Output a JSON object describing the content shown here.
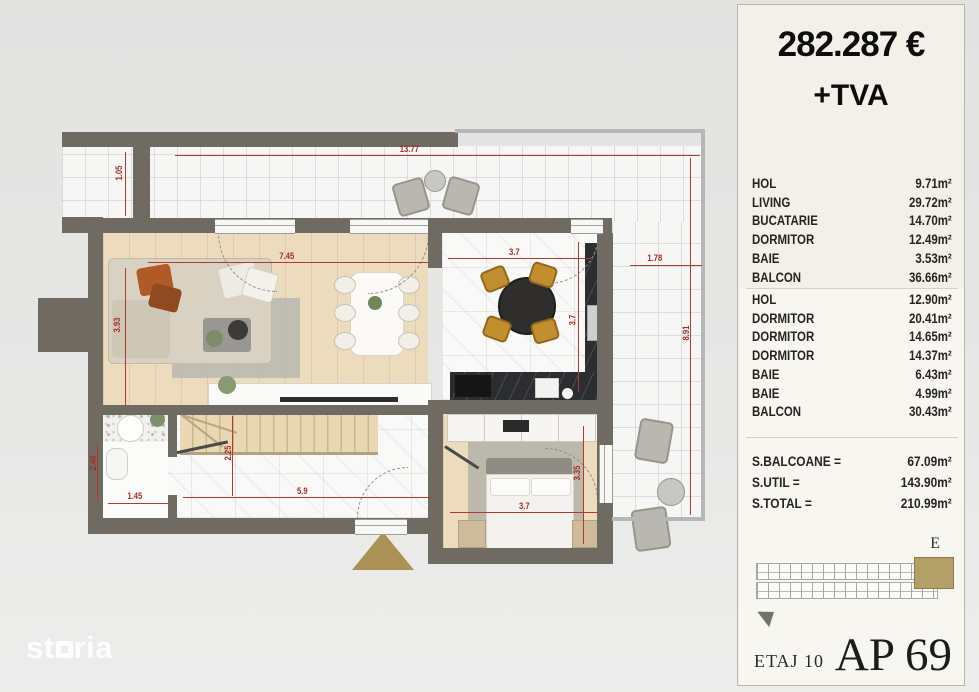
{
  "panel": {
    "price": "282.287 €",
    "vat": "+TVA",
    "rooms1": [
      {
        "label": "HOL",
        "area": "9.71m²"
      },
      {
        "label": "LIVING",
        "area": "29.72m²"
      },
      {
        "label": "BUCATARIE",
        "area": "14.70m²"
      },
      {
        "label": "DORMITOR",
        "area": "12.49m²"
      },
      {
        "label": "BAIE",
        "area": "3.53m²"
      },
      {
        "label": "BALCON",
        "area": "36.66m²"
      }
    ],
    "rooms2": [
      {
        "label": "HOL",
        "area": "12.90m²"
      },
      {
        "label": "DORMITOR",
        "area": "20.41m²"
      },
      {
        "label": "DORMITOR",
        "area": "14.65m²"
      },
      {
        "label": "DORMITOR",
        "area": "14.37m²"
      },
      {
        "label": "BAIE",
        "area": "6.43m²"
      },
      {
        "label": "BAIE",
        "area": "4.99m²"
      },
      {
        "label": "BALCON",
        "area": "30.43m²"
      }
    ],
    "totals": [
      {
        "label": "S.BALCOANE =",
        "value": "67.09m²"
      },
      {
        "label": "S.UTIL =",
        "value": "143.90m²"
      },
      {
        "label": "S.TOTAL =",
        "value": "210.99m²"
      }
    ],
    "section_label": "E",
    "floor_label": "ETAJ 10",
    "apartment_label": "AP 69"
  },
  "plan": {
    "watermark_prefix": "st",
    "watermark_suffix": "ria",
    "dims": {
      "balcony_top_width": "13.77",
      "balcony_left_depth": "1.05",
      "living_width": "7.45",
      "living_depth": "3.93",
      "kitchen_width": "3.7",
      "kitchen_depth": "3.7",
      "balcony_right_width": "1.78",
      "balcony_right_height": "8.91",
      "stairs_depth": "2.25",
      "hall_width": "5.9",
      "bath_width": "1.45",
      "bath_depth": "2.40",
      "bedroom_width": "3.7",
      "bedroom_depth": "3.35"
    }
  },
  "colors": {
    "dimension_red": "#a32e26",
    "wall_grey": "#6f6b63",
    "highlight_gold": "#b3a069",
    "panel_bg": "#f3f0e9"
  }
}
